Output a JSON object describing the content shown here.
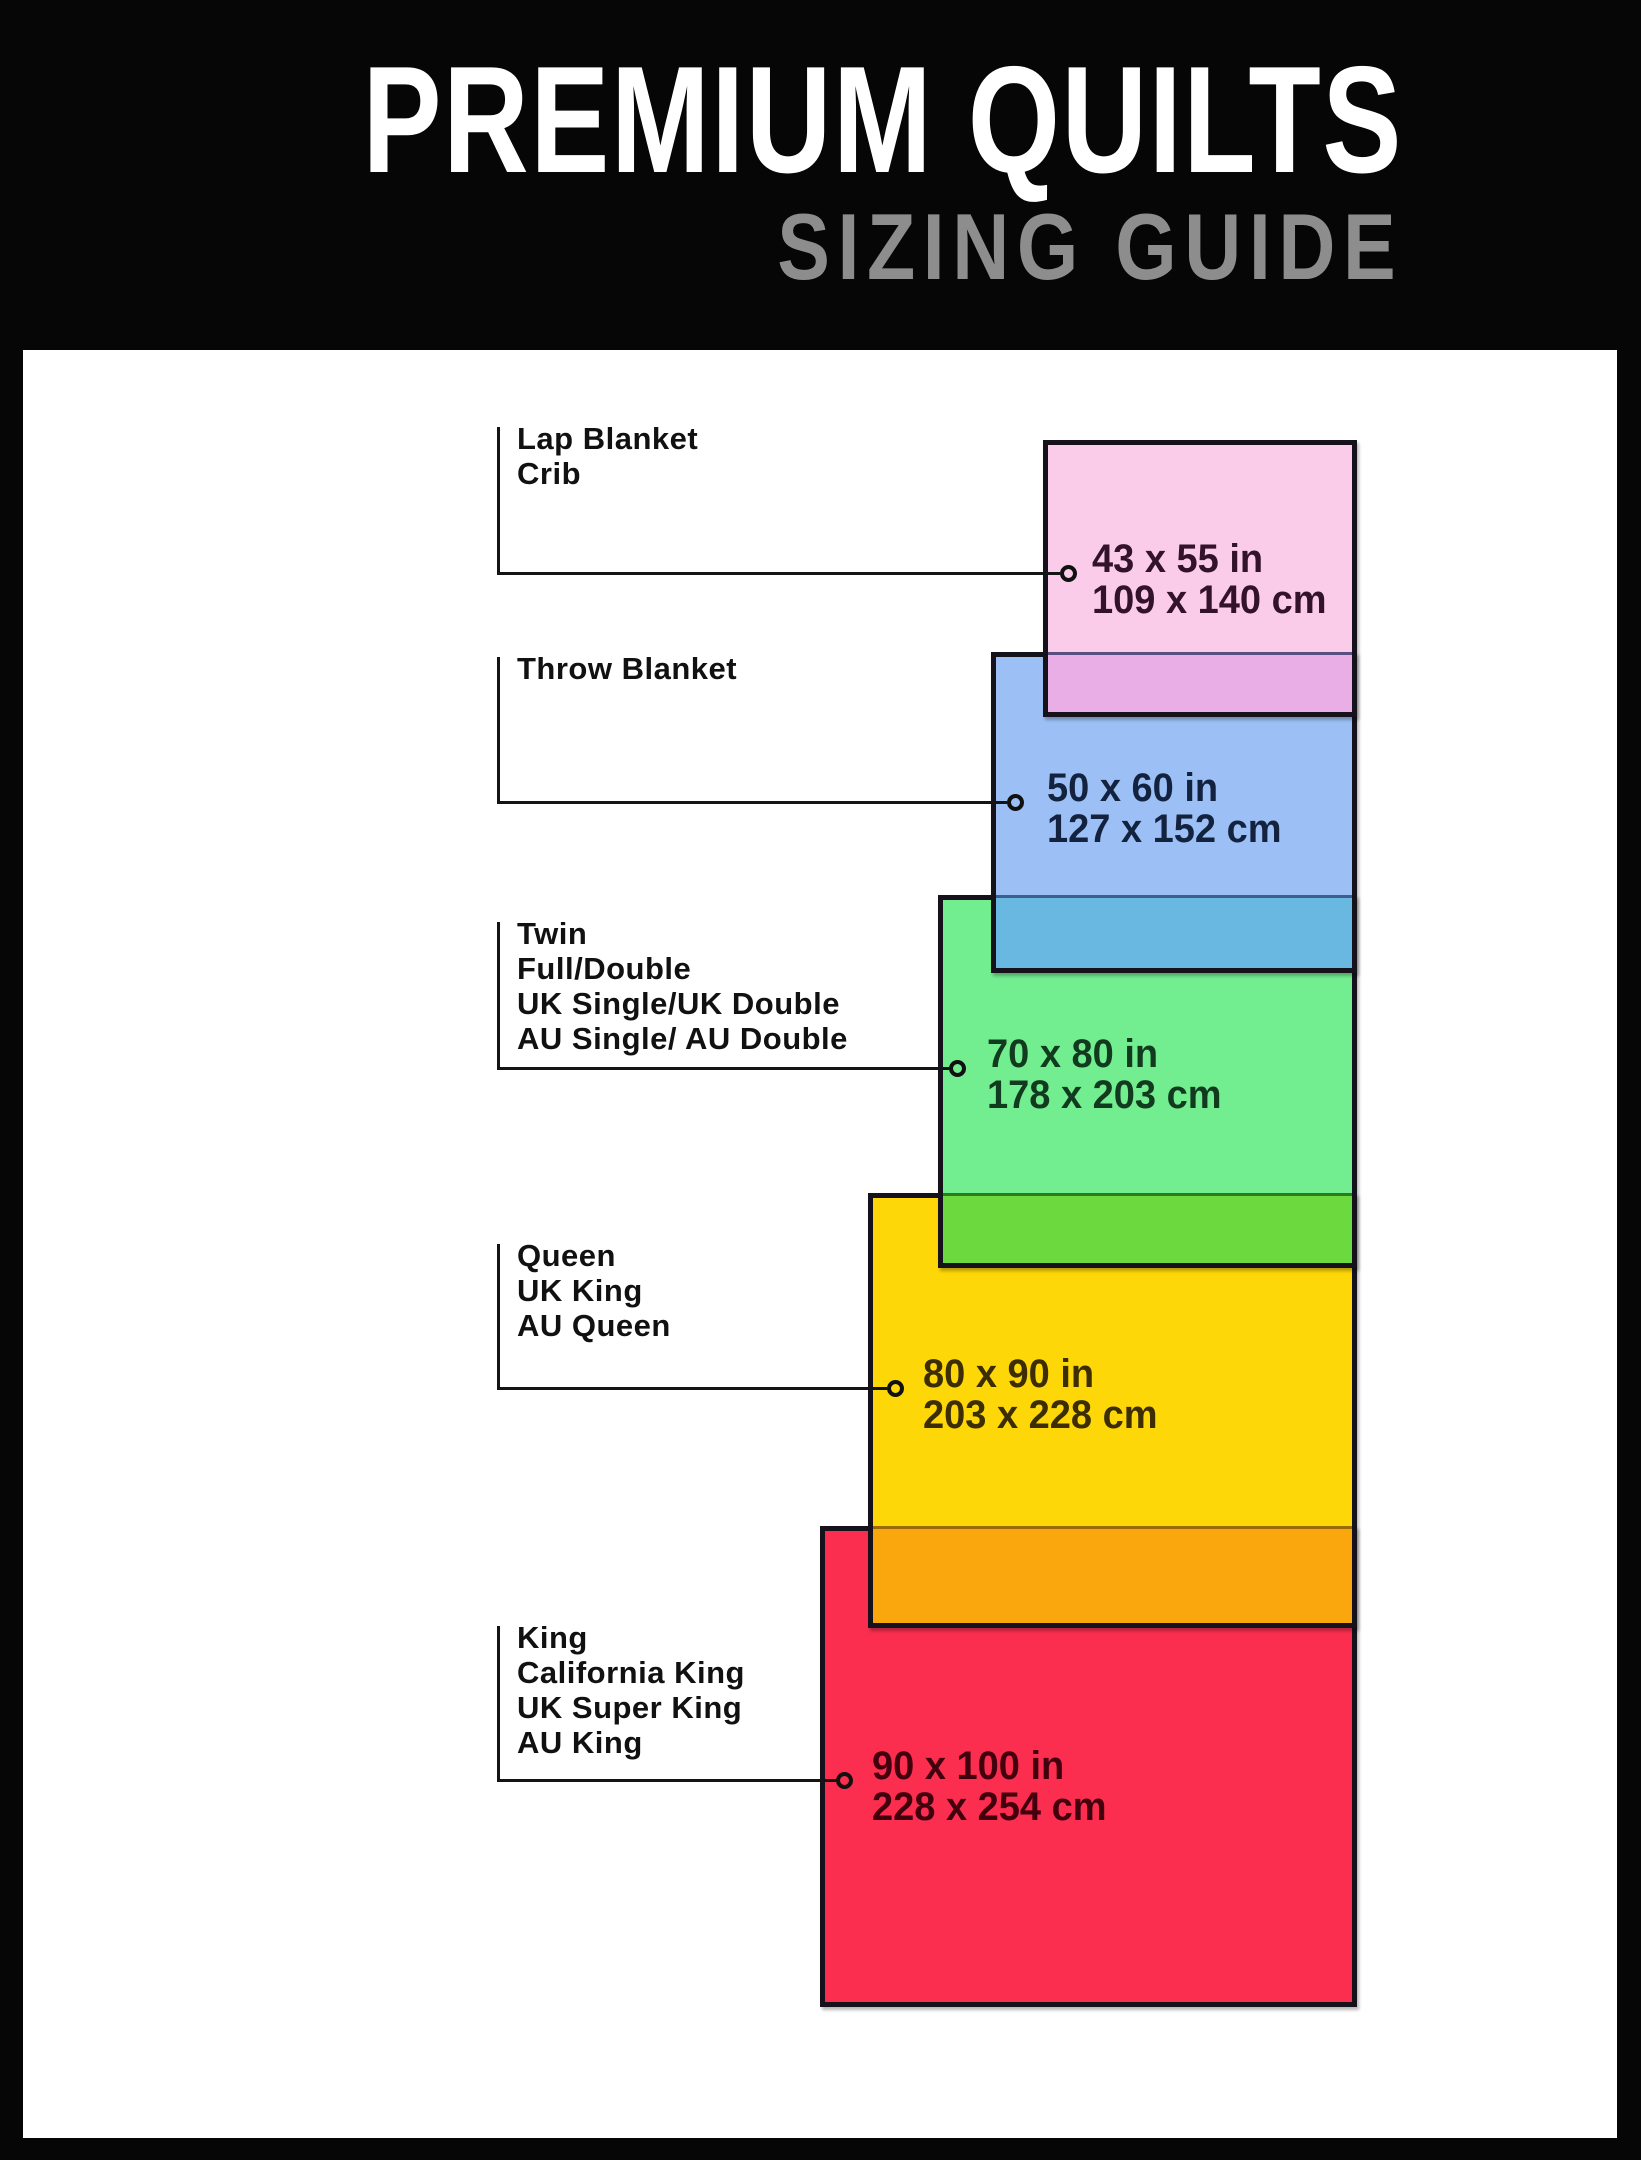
{
  "header": {
    "title": "PREMIUM QUILTS",
    "subtitle": "SIZING GUIDE"
  },
  "colors": {
    "canvas_bg": "#060606",
    "panel_bg": "#ffffff",
    "rect_border": "#16121c",
    "annotation_line": "#141414",
    "title_color": "#ffffff",
    "subtitle_color": "#8d8d8d",
    "label_text": "#111111"
  },
  "chart_data": {
    "type": "diagram",
    "title": "PREMIUM QUILTS — SIZING GUIDE",
    "description": "Overlapping rectangles compare quilt sizes, right-aligned, smallest on top",
    "layout_constants": {
      "label_line_x": 497,
      "label_text_x": 517,
      "shared_right_edge": 1357
    },
    "quilts": [
      {
        "id": "lap-blanket-crib",
        "label_lines": [
          "Lap Blanket",
          "Crib"
        ],
        "size_in": "43 x 55 in",
        "size_cm": "109 x 140 cm",
        "width_in": 43,
        "height_in": 55,
        "width_cm": 109,
        "height_cm": 140,
        "fill": "#fbcce9",
        "text_color": "#33122b",
        "layout": {
          "rect": {
            "left": 1043,
            "top": 440,
            "width": 314,
            "height": 277
          },
          "label_top": 421,
          "connector_y": 573,
          "circle_x": 1068,
          "dims_x": 1092
        }
      },
      {
        "id": "throw-blanket",
        "label_lines": [
          "Throw Blanket"
        ],
        "size_in": "50 x 60 in",
        "size_cm": "127 x 152 cm",
        "width_in": 50,
        "height_in": 60,
        "width_cm": 127,
        "height_cm": 152,
        "fill": "#9cc0f5",
        "text_color": "#13233f",
        "overlap_color": "#e9aee6",
        "overlap_line_color": "#5a4f82",
        "layout": {
          "rect": {
            "left": 991,
            "top": 652,
            "width": 366,
            "height": 321
          },
          "label_top": 651,
          "connector_y": 802,
          "circle_x": 1015,
          "dims_x": 1047
        }
      },
      {
        "id": "twin-full-double",
        "label_lines": [
          "Twin",
          "Full/Double",
          "UK Single/UK Double",
          "AU Single/ AU Double"
        ],
        "size_in": "70 x 80 in",
        "size_cm": "178 x 203 cm",
        "width_in": 70,
        "height_in": 80,
        "width_cm": 178,
        "height_cm": 203,
        "fill": "#72ee90",
        "text_color": "#123a1e",
        "overlap_color": "#68b8e2",
        "overlap_line_color": "#3d5e8e",
        "layout": {
          "rect": {
            "left": 938,
            "top": 895,
            "width": 419,
            "height": 373
          },
          "label_top": 916,
          "connector_y": 1068,
          "circle_x": 957,
          "dims_x": 987
        }
      },
      {
        "id": "queen-uk-king-au-queen",
        "label_lines": [
          "Queen",
          "UK King",
          "AU Queen"
        ],
        "size_in": "80 x 90 in",
        "size_cm": "203 x 228 cm",
        "width_in": 80,
        "height_in": 90,
        "width_cm": 203,
        "height_cm": 228,
        "fill": "#fdd707",
        "text_color": "#3c2d03",
        "overlap_color": "#6cda3f",
        "overlap_line_color": "#2f7a1e",
        "layout": {
          "rect": {
            "left": 868,
            "top": 1193,
            "width": 489,
            "height": 435
          },
          "label_top": 1238,
          "connector_y": 1388,
          "circle_x": 895,
          "dims_x": 923
        }
      },
      {
        "id": "king-california-king",
        "label_lines": [
          "King",
          "California King",
          "UK Super King",
          "AU King"
        ],
        "size_in": "90 x 100 in",
        "size_cm": "228 x 254 cm",
        "width_in": 90,
        "height_in": 100,
        "width_cm": 228,
        "height_cm": 254,
        "fill": "#fb2e4f",
        "text_color": "#42000f",
        "overlap_color": "#f9a70d",
        "overlap_line_color": "#9a6a05",
        "layout": {
          "rect": {
            "left": 820,
            "top": 1526,
            "width": 537,
            "height": 481
          },
          "label_top": 1620,
          "connector_y": 1780,
          "circle_x": 844,
          "dims_x": 872
        }
      }
    ]
  }
}
